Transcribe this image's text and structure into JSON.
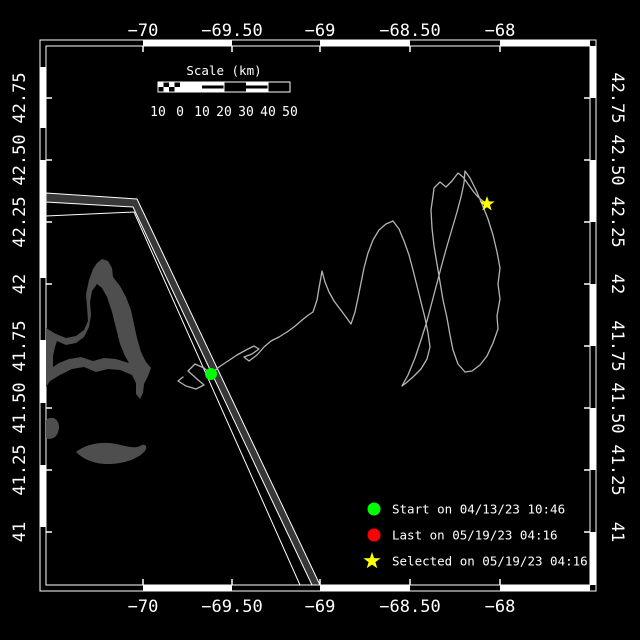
{
  "colors": {
    "background": "#000000",
    "frame": "#ffffff",
    "land": "#4e4e4e",
    "lane_fill": "#383838",
    "lane_border": "#ffffff",
    "track": "#b4b4b4",
    "start_marker": "#00ff00",
    "last_marker": "#ff0000",
    "selected_marker": "#ffff00",
    "text": "#ffffff"
  },
  "axes": {
    "top_ticks": [
      "−70",
      "−69.50",
      "−69",
      "−68.50",
      "−68"
    ],
    "bottom_ticks": [
      "−70",
      "−69.50",
      "−69",
      "−68.50",
      "−68"
    ],
    "left_ticks": [
      "42.75",
      "42.50",
      "42.25",
      "42",
      "41.75",
      "41.50",
      "41.25",
      "41"
    ],
    "right_ticks": [
      "42.75",
      "42.50",
      "42.25",
      "42",
      "41.75",
      "41.50",
      "41.25",
      "41"
    ]
  },
  "scale_bar": {
    "title": "Scale (km)",
    "labels": [
      "10",
      "0",
      "10",
      "20",
      "30",
      "40",
      "50"
    ]
  },
  "legend": {
    "items": [
      {
        "shape": "circle",
        "color": "#00ff00",
        "label": "Start on 04/13/23 10:46"
      },
      {
        "shape": "circle",
        "color": "#ff0000",
        "label": "Last on 05/19/23 04:16"
      },
      {
        "shape": "star",
        "color": "#ffff00",
        "label": "Selected on 05/19/23 04:16"
      }
    ],
    "star_points": "372,552 374.1,558.1 380.6,558.2 375.4,562.1 377.3,568.3 372,564.6 366.7,568.3 368.6,562.1 363.4,558.2 369.9,558.1"
  },
  "markers": {
    "start": {
      "cx": "211",
      "cy": "374"
    },
    "selected": {
      "cx": "487",
      "cy": "204",
      "star_points": "487,196 488.9,201.4 494.6,201.5 490,205 491.7,210.5 487,207.2 482.3,210.5 484,205 479.4,201.5 485.1,201.4"
    }
  },
  "track": {
    "points": "183,377 178,381 186,386 196,389 204,385 197,379 188,371 195,364 204,368 211,374 219,367 228,361 237,355 246,350 254,346 259,349 252,354 244,357 249,361 257,355 264,347 271,341 279,337 287,332 294,327 301,321 307,316 313,312 317,300 319,288 321,277 322,271 325,282 329,292 334,301 340,309 346,317 351,324 355,312 358,298 361,283 364,268 368,253 373,240 379,230 386,224 393,221 399,229 404,241 409,255 413,270 417,286 421,302 425,318 428,333 430,347 427,359 421,369 413,377 406,383 402,386 408,375 415,358 421,340 427,321 432,302 437,283 442,264 447,246 452,229 457,212 461,197 464,183 465,171 470,178 476,190 482,204 488,219 493,235 497,252 500,268 498,284 500,299 497,316 498,329 493,343 487,356 480,365 472,371 465,372 458,364 453,350 450,335 447,318 443,300 440,282 437,264 434,246 432,228 431,210 433,196 434,188 440,182 446,187 452,181 458,173 463,177 468,184 473,191 478,197 483,201 487,204"
  },
  "geography": {
    "cape_cod_d": "M46,328 L56,334 L66,338 L76,336 L84,330 L88,321 L87,307 L86,294 L89,280 L93,269 L97,263 L102,259 L108,261 L112,268 L113,277 L120,286 L126,297 L131,310 L134,324 L137,338 L141,352 L146,362 L151,368 L148,376 L144,384 L143,393 L140,399 L136,394 L136,383 L132,375 L120,370 L108,369 L96,372 L84,367 L72,369 L60,375 L50,381 L46,387 Z M57,341 L66,345 L76,343 L84,337 L89,327 L91,315 L90,302 L92,291 L97,284 L102,288 L107,297 L112,312 L116,328 L120,344 L125,356 L129,363 L116,359 L104,358 L93,361 L81,357 L69,359 L59,363 L53,367 L53,356 L55,347 Z",
    "island_d": "M46,420 C52,415 59,419 59,427 C59,436 52,441 46,438 Z",
    "nantucket_d": "M76,452 C86,444 101,441 116,444 C126,446 134,449 140,446 C145,443 148,446 145,451 C138,459 124,464 107,464 C94,464 83,459 76,452 Z",
    "lane_band_d": "M46,193 L137,199 L320,585 L312,585 L133,207 L46,202 Z",
    "lane_line_points": "46,216 134,212 300,585"
  }
}
